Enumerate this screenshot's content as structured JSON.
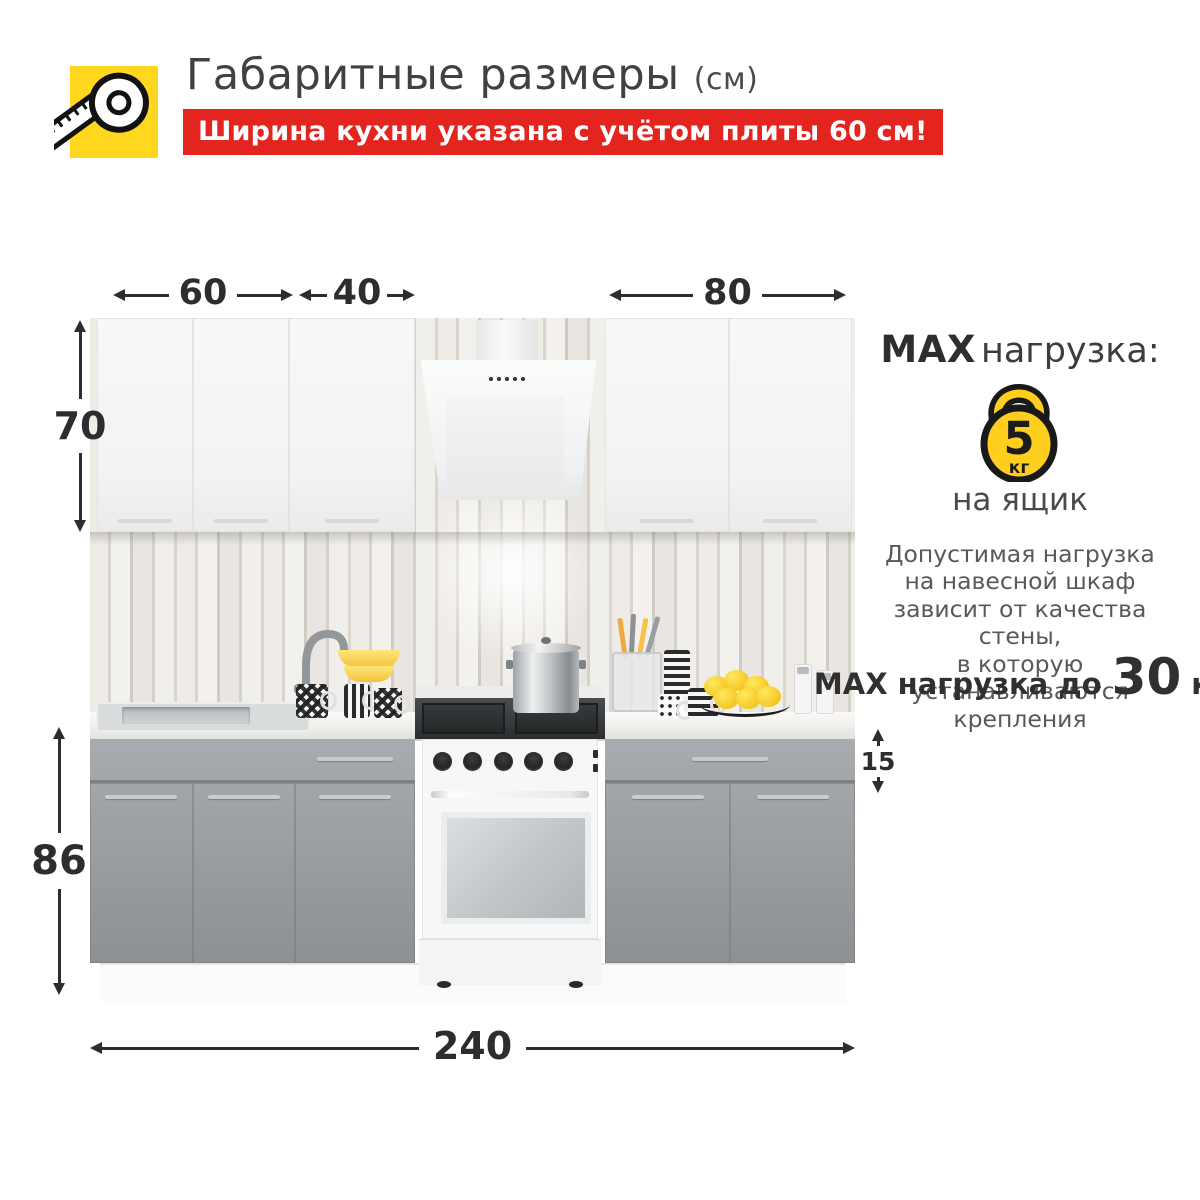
{
  "header": {
    "title": "Габаритные размеры",
    "title_suffix": "(см)",
    "banner_text": "Ширина кухни указана с учётом плиты 60 см!"
  },
  "dimensions": {
    "cabinet_left_width": "60",
    "cabinet_mid_width": "40",
    "cabinet_right_width": "80",
    "upper_height": "70",
    "lower_height": "86",
    "drawer_height": "15",
    "total_width": "240"
  },
  "max_load": {
    "title_max": "MAX",
    "title_rest": "нагрузка:",
    "kettlebell_value": "5",
    "kettlebell_unit": "кг",
    "caption": "на ящик",
    "note_lines": [
      "Допустимая нагрузка",
      "на навесной шкаф",
      "зависит от качества стены,",
      "в которую устанавливаются",
      "крепления"
    ],
    "footer_prefix": "MAX нагрузка до",
    "footer_value": "30",
    "footer_unit": "кг"
  },
  "colors": {
    "accent_red": "#e3241f",
    "accent_yellow": "#ffd51e",
    "arrow_ink": "#2d2d2d",
    "cabinet_gray": "#9a9ea1",
    "cabinet_white": "#f5f6f6"
  }
}
